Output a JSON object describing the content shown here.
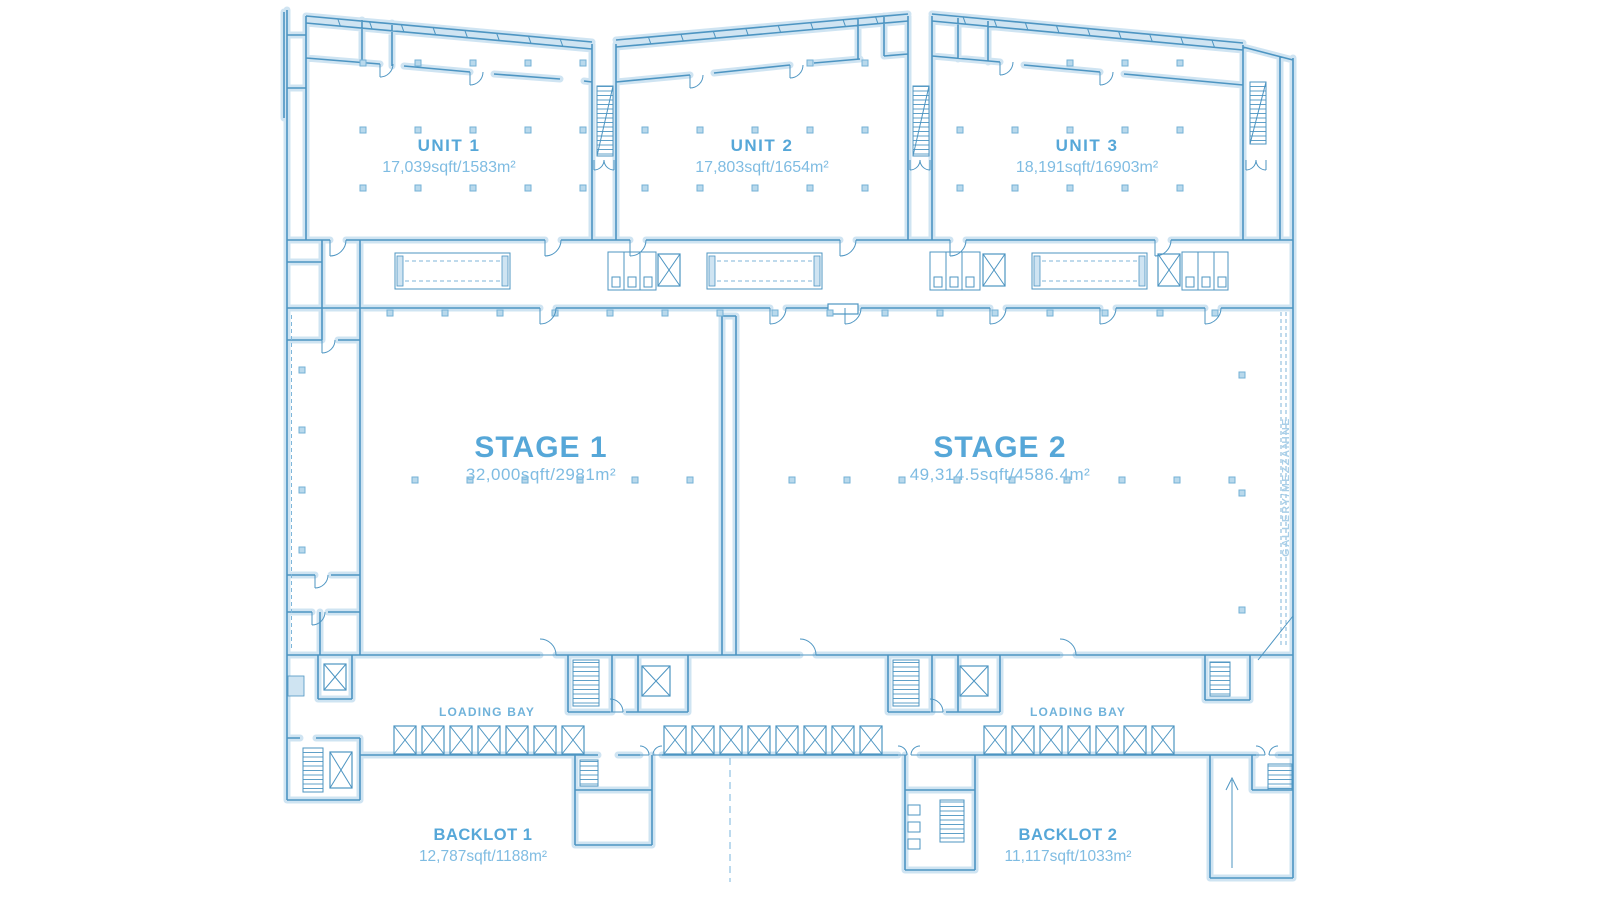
{
  "palette": {
    "wall_line": "#4d95c2",
    "wall_casing": "#cfe4f2",
    "heading_text": "#56a7d8",
    "body_text": "#7fbce2",
    "dashed_line": "#7fb6da",
    "background": "#ffffff"
  },
  "plan": {
    "units": [
      {
        "id": "unit1",
        "label": "UNIT 1",
        "area": "17,039sqft/1583m²"
      },
      {
        "id": "unit2",
        "label": "UNIT 2",
        "area": "17,803sqft/1654m²"
      },
      {
        "id": "unit3",
        "label": "UNIT 3",
        "area": "18,191sqft/16903m²"
      }
    ],
    "stages": [
      {
        "id": "stage1",
        "label": "STAGE 1",
        "area": "32,000sqft/2981m²"
      },
      {
        "id": "stage2",
        "label": "STAGE 2",
        "area": "49,314.5sqft/4586.4m²"
      }
    ],
    "backlots": [
      {
        "id": "backlot1",
        "label": "BACKLOT 1",
        "area": "12,787sqft/1188m²"
      },
      {
        "id": "backlot2",
        "label": "BACKLOT 2",
        "area": "11,117sqft/1033m²"
      }
    ],
    "annotations": {
      "loading_bay_left": "LOADING BAY",
      "loading_bay_right": "LOADING BAY",
      "gallery_mezzanine": "GALLERY/MEZZANINE"
    }
  }
}
